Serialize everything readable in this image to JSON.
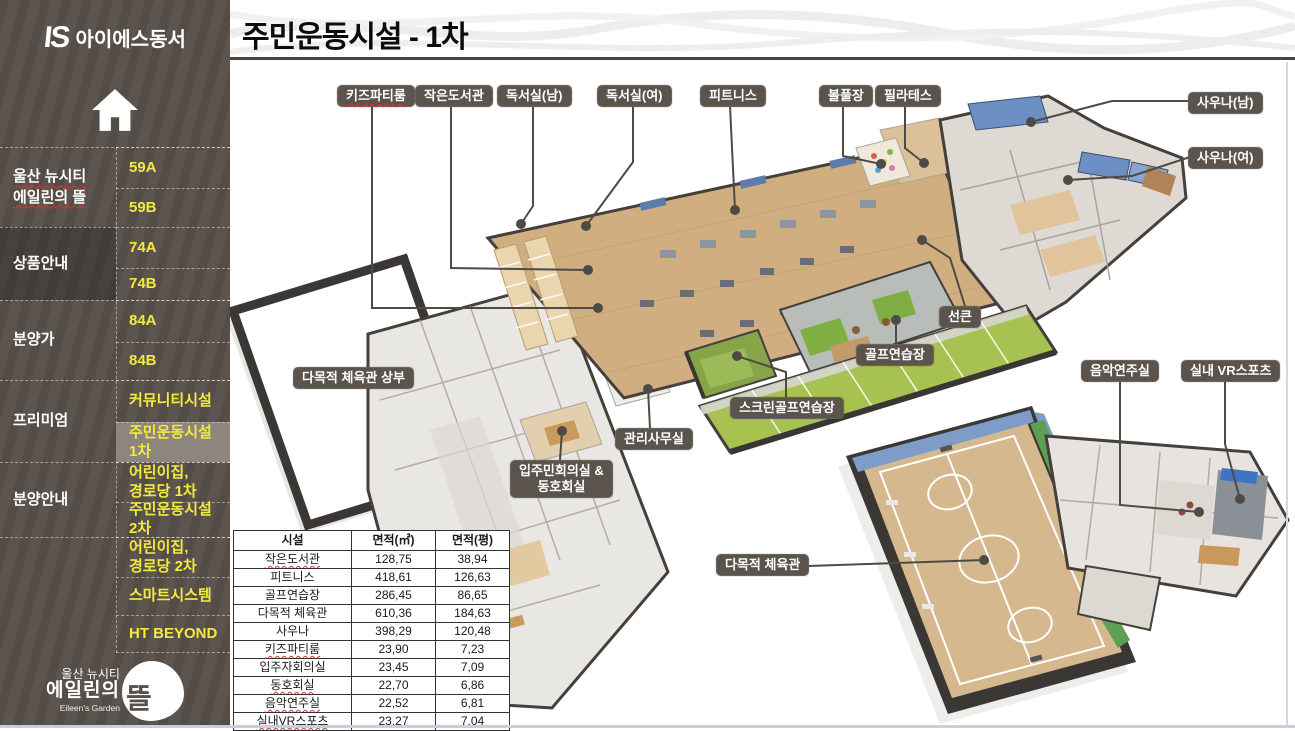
{
  "brand": {
    "mark": "IS",
    "name": "아이에스동서"
  },
  "header": {
    "title": "주민운동시설 - 1차"
  },
  "sidebar": {
    "groups": [
      {
        "id": "project",
        "label": "울산 뉴시티\n에일린의 뜰",
        "top": 147,
        "height": 80,
        "squiggle": true
      },
      {
        "id": "products",
        "label": "상품안내",
        "top": 227,
        "height": 73,
        "highlight": true
      },
      {
        "id": "price",
        "label": "분양가",
        "top": 300,
        "height": 80
      },
      {
        "id": "premium",
        "label": "프리미엄",
        "top": 380,
        "height": 82
      },
      {
        "id": "sales-info",
        "label": "분양안내",
        "top": 462,
        "height": 75
      },
      {
        "id": "extra",
        "label": "",
        "top": 537,
        "height": 116
      }
    ],
    "items": [
      {
        "id": "59a",
        "label": "59A",
        "top": 147,
        "height": 41
      },
      {
        "id": "59b",
        "label": "59B",
        "top": 188,
        "height": 39
      },
      {
        "id": "74a",
        "label": "74A",
        "top": 227,
        "height": 41
      },
      {
        "id": "74b",
        "label": "74B",
        "top": 268,
        "height": 32
      },
      {
        "id": "84a",
        "label": "84A",
        "top": 300,
        "height": 42
      },
      {
        "id": "84b",
        "label": "84B",
        "top": 342,
        "height": 38
      },
      {
        "id": "community",
        "label": "커뮤니티시설",
        "top": 380,
        "height": 42
      },
      {
        "id": "sports-1",
        "label": "주민운동시설\n1차",
        "top": 422,
        "height": 40,
        "selected": true
      },
      {
        "id": "daycare-1",
        "label": "어린이집,\n경로당 1차",
        "top": 462,
        "height": 40
      },
      {
        "id": "sports-2",
        "label": "주민운동시설\n2차",
        "top": 502,
        "height": 35
      },
      {
        "id": "daycare-2",
        "label": "어린이집,\n경로당 2차",
        "top": 537,
        "height": 40
      },
      {
        "id": "smart",
        "label": "스마트시스템",
        "top": 577,
        "height": 38
      },
      {
        "id": "ht-beyond",
        "label": "HT BEYOND",
        "top": 615,
        "height": 38
      }
    ],
    "footer": {
      "line1": "울산 뉴시티",
      "line2": "에일린의",
      "sub": "Eileen's Garden",
      "mark": "뜰"
    }
  },
  "plan": {
    "callouts": [
      {
        "id": "kids-party-room",
        "label": "키즈파티룸",
        "x": 337,
        "y": 85,
        "squiggle": true,
        "line": [
          [
            372,
            106
          ],
          [
            372,
            308
          ],
          [
            598,
            308
          ]
        ]
      },
      {
        "id": "small-library",
        "label": "작은도서관",
        "x": 415,
        "y": 85,
        "line": [
          [
            451,
            106
          ],
          [
            451,
            268
          ],
          [
            588,
            270
          ]
        ]
      },
      {
        "id": "reading-room-m",
        "label": "독서실(남)",
        "x": 497,
        "y": 85,
        "line": [
          [
            533,
            106
          ],
          [
            533,
            206
          ],
          [
            521,
            224
          ]
        ]
      },
      {
        "id": "reading-room-f",
        "label": "독서실(여)",
        "x": 597,
        "y": 85,
        "line": [
          [
            633,
            106
          ],
          [
            633,
            162
          ],
          [
            586,
            226
          ]
        ]
      },
      {
        "id": "fitness",
        "label": "피트니스",
        "x": 700,
        "y": 85,
        "line": [
          [
            730,
            106
          ],
          [
            735,
            210
          ]
        ]
      },
      {
        "id": "ball-pool",
        "label": "볼풀장",
        "x": 819,
        "y": 85,
        "line": [
          [
            843,
            106
          ],
          [
            843,
            156
          ],
          [
            881,
            164
          ]
        ]
      },
      {
        "id": "pilates",
        "label": "필라테스",
        "x": 875,
        "y": 85,
        "line": [
          [
            905,
            106
          ],
          [
            905,
            148
          ],
          [
            924,
            163
          ]
        ]
      },
      {
        "id": "sauna-m",
        "label": "사우나(남)",
        "x": 1188,
        "y": 92,
        "line": [
          [
            1190,
            101
          ],
          [
            1112,
            101
          ],
          [
            1031,
            122
          ]
        ]
      },
      {
        "id": "sauna-f",
        "label": "사우나(여)",
        "x": 1188,
        "y": 147,
        "line": [
          [
            1190,
            157
          ],
          [
            1132,
            176
          ],
          [
            1068,
            180
          ]
        ]
      },
      {
        "id": "sunken",
        "label": "선큰",
        "x": 939,
        "y": 306,
        "line": [
          [
            965,
            306
          ],
          [
            950,
            258
          ],
          [
            922,
            240
          ]
        ]
      },
      {
        "id": "golf-range",
        "label": "골프연습장",
        "x": 856,
        "y": 344,
        "line": [
          [
            896,
            344
          ],
          [
            896,
            320
          ]
        ]
      },
      {
        "id": "screen-golf",
        "label": "스크린골프연습장",
        "x": 730,
        "y": 397,
        "line": [
          [
            786,
            397
          ],
          [
            786,
            372
          ],
          [
            737,
            356
          ]
        ]
      },
      {
        "id": "management-office",
        "label": "관리사무실",
        "x": 615,
        "y": 428,
        "line": [
          [
            650,
            428
          ],
          [
            648,
            389
          ]
        ]
      },
      {
        "id": "meeting-club",
        "label": "입주민회의실 &\n동호회실",
        "x": 510,
        "y": 460,
        "line": [
          [
            560,
            460
          ],
          [
            562,
            431
          ]
        ]
      },
      {
        "id": "gym-upper",
        "label": "다목적 체육관 상부",
        "x": 293,
        "y": 367
      },
      {
        "id": "gym",
        "label": "다목적 체육관",
        "x": 716,
        "y": 554,
        "line": [
          [
            808,
            566
          ],
          [
            984,
            560
          ]
        ]
      },
      {
        "id": "music-room",
        "label": "음악연주실",
        "x": 1081,
        "y": 360,
        "line": [
          [
            1120,
            382
          ],
          [
            1120,
            505
          ],
          [
            1199,
            512
          ]
        ]
      },
      {
        "id": "vr-sports",
        "label": "실내 VR스포츠",
        "x": 1181,
        "y": 360,
        "line": [
          [
            1225,
            382
          ],
          [
            1225,
            444
          ],
          [
            1240,
            499
          ]
        ]
      }
    ]
  },
  "table": {
    "headers": [
      "시설",
      "면적(㎡)",
      "면적(평)"
    ],
    "rows": [
      {
        "name": "작은도서관",
        "m2": "128,75",
        "pyeong": "38,94",
        "squiggle": true
      },
      {
        "name": "피트니스",
        "m2": "418,61",
        "pyeong": "126,63"
      },
      {
        "name": "골프연습장",
        "m2": "286,45",
        "pyeong": "86,65"
      },
      {
        "name": "다목적 체육관",
        "m2": "610,36",
        "pyeong": "184,63"
      },
      {
        "name": "사우나",
        "m2": "398,29",
        "pyeong": "120,48"
      },
      {
        "name": "키즈파티룸",
        "m2": "23,90",
        "pyeong": "7,23",
        "squiggle": true
      },
      {
        "name": "입주자회의실",
        "m2": "23,45",
        "pyeong": "7,09"
      },
      {
        "name": "동호회실",
        "m2": "22,70",
        "pyeong": "6,86",
        "squiggle": true
      },
      {
        "name": "음악연주실",
        "m2": "22,52",
        "pyeong": "6,81",
        "squiggle": true
      },
      {
        "name": "실내VR스포츠",
        "m2": "23,27",
        "pyeong": "7,04",
        "squiggle": true
      }
    ]
  },
  "colors": {
    "sidebar_bg": "#58514b",
    "accent_yellow": "#f2ea3c",
    "selected_bg": "#8c867f",
    "badge_bg": "#5b544d",
    "wall": "#3b3734",
    "wood": "#d0ae7f",
    "golf_green": "#a8c252",
    "pool_blue": "#6c8fc4",
    "squiggle_red": "#e0322a"
  }
}
